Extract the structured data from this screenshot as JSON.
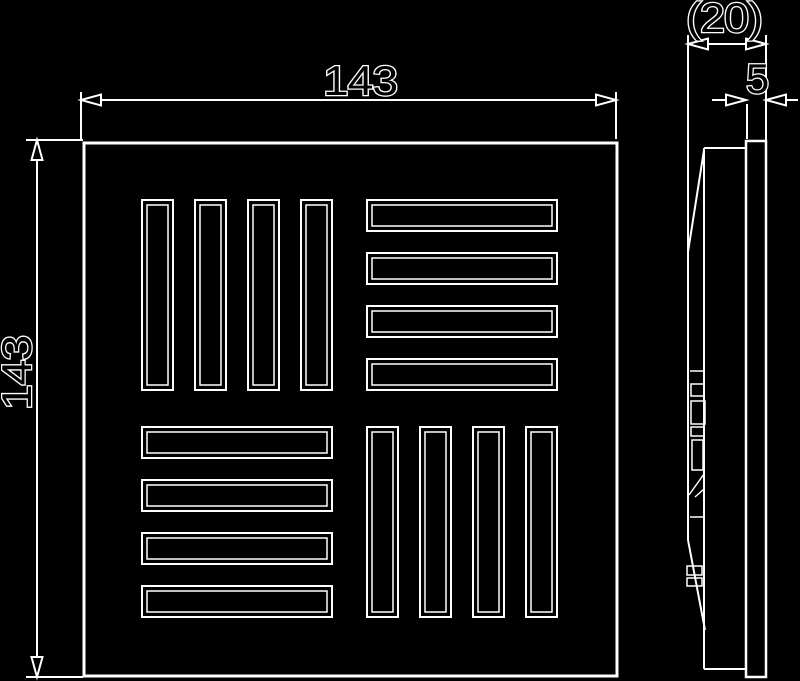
{
  "drawing": {
    "type": "technical-drawing",
    "colors": {
      "background": "#000000",
      "line": "#ffffff",
      "text_fill": "#000000",
      "text_outline": "#ffffff"
    },
    "dimensions": {
      "front_width": "143",
      "front_height": "143",
      "side_depth": "(20)",
      "side_thickness": "5"
    },
    "grille": {
      "quadrants": 4,
      "slots_per_quadrant": 4
    }
  }
}
